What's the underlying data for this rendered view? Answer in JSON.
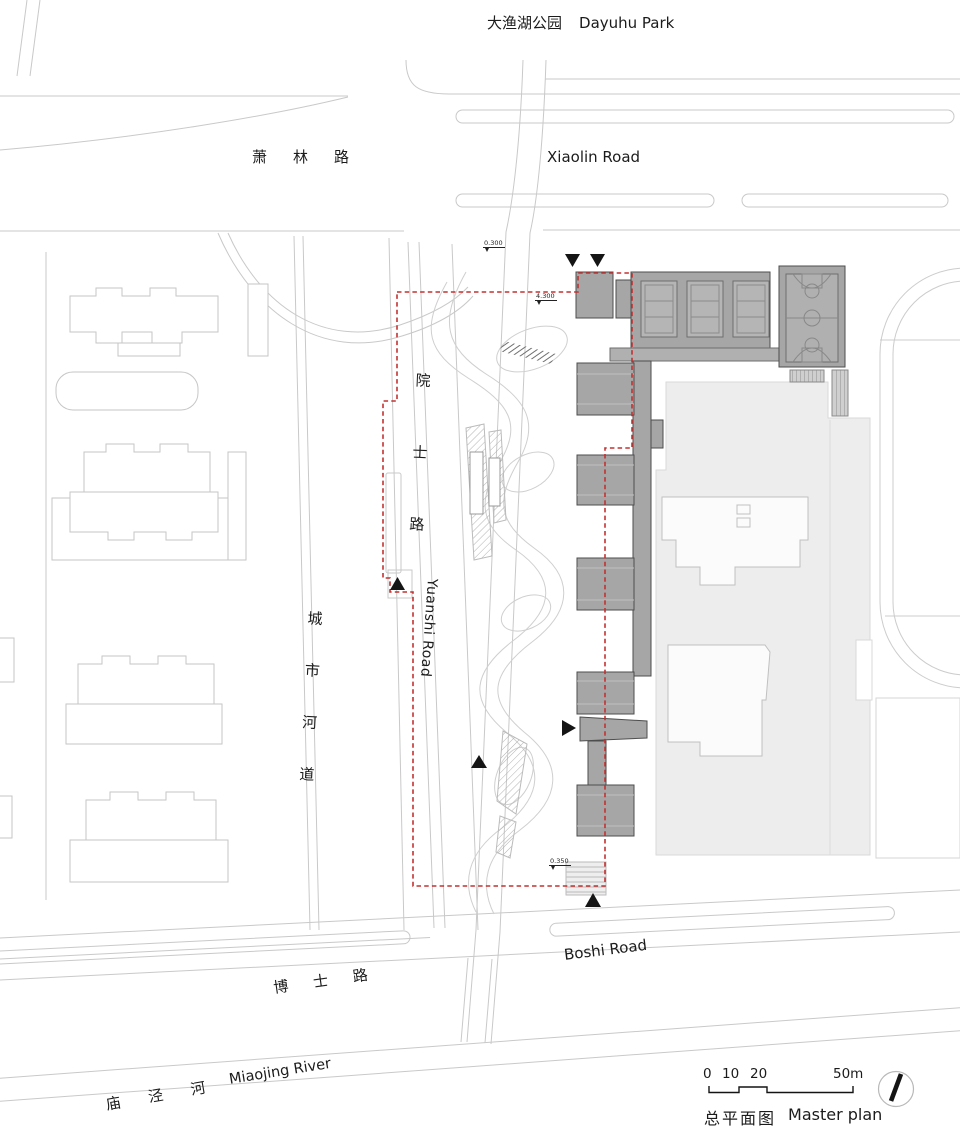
{
  "drawing": {
    "title_cn": "总平面图",
    "title_en": "Master plan",
    "scale_ticks": [
      "0",
      "10",
      "20",
      "50m"
    ],
    "elevation_marks": [
      "0.300",
      "4.300",
      "0.350"
    ]
  },
  "labels": {
    "park_cn": "大渔湖公园",
    "park_en": "Dayuhu Park",
    "xiaolin_cn": "萧林路",
    "xiaolin_en": "Xiaolin Road",
    "yuanshi_cn": "院士路",
    "yuanshi_en": "Yuanshi Road",
    "city_river_cn": "城市河道",
    "boshi_cn": "博士路",
    "boshi_en": "Boshi Road",
    "miaojing_cn": "庙泾河",
    "miaojing_en": "Miaojing River"
  },
  "colors": {
    "site_boundary": "#C43131",
    "building_fill": "#A6A6A6",
    "context_mass_fill": "#EDEDED",
    "linework": "#C9C9C9",
    "marker": "#151515",
    "background": "#FFFFFF"
  },
  "icons": {
    "north_arrow": "north-arrow-icon",
    "entrance_markers": "entrance-triangle-markers"
  }
}
